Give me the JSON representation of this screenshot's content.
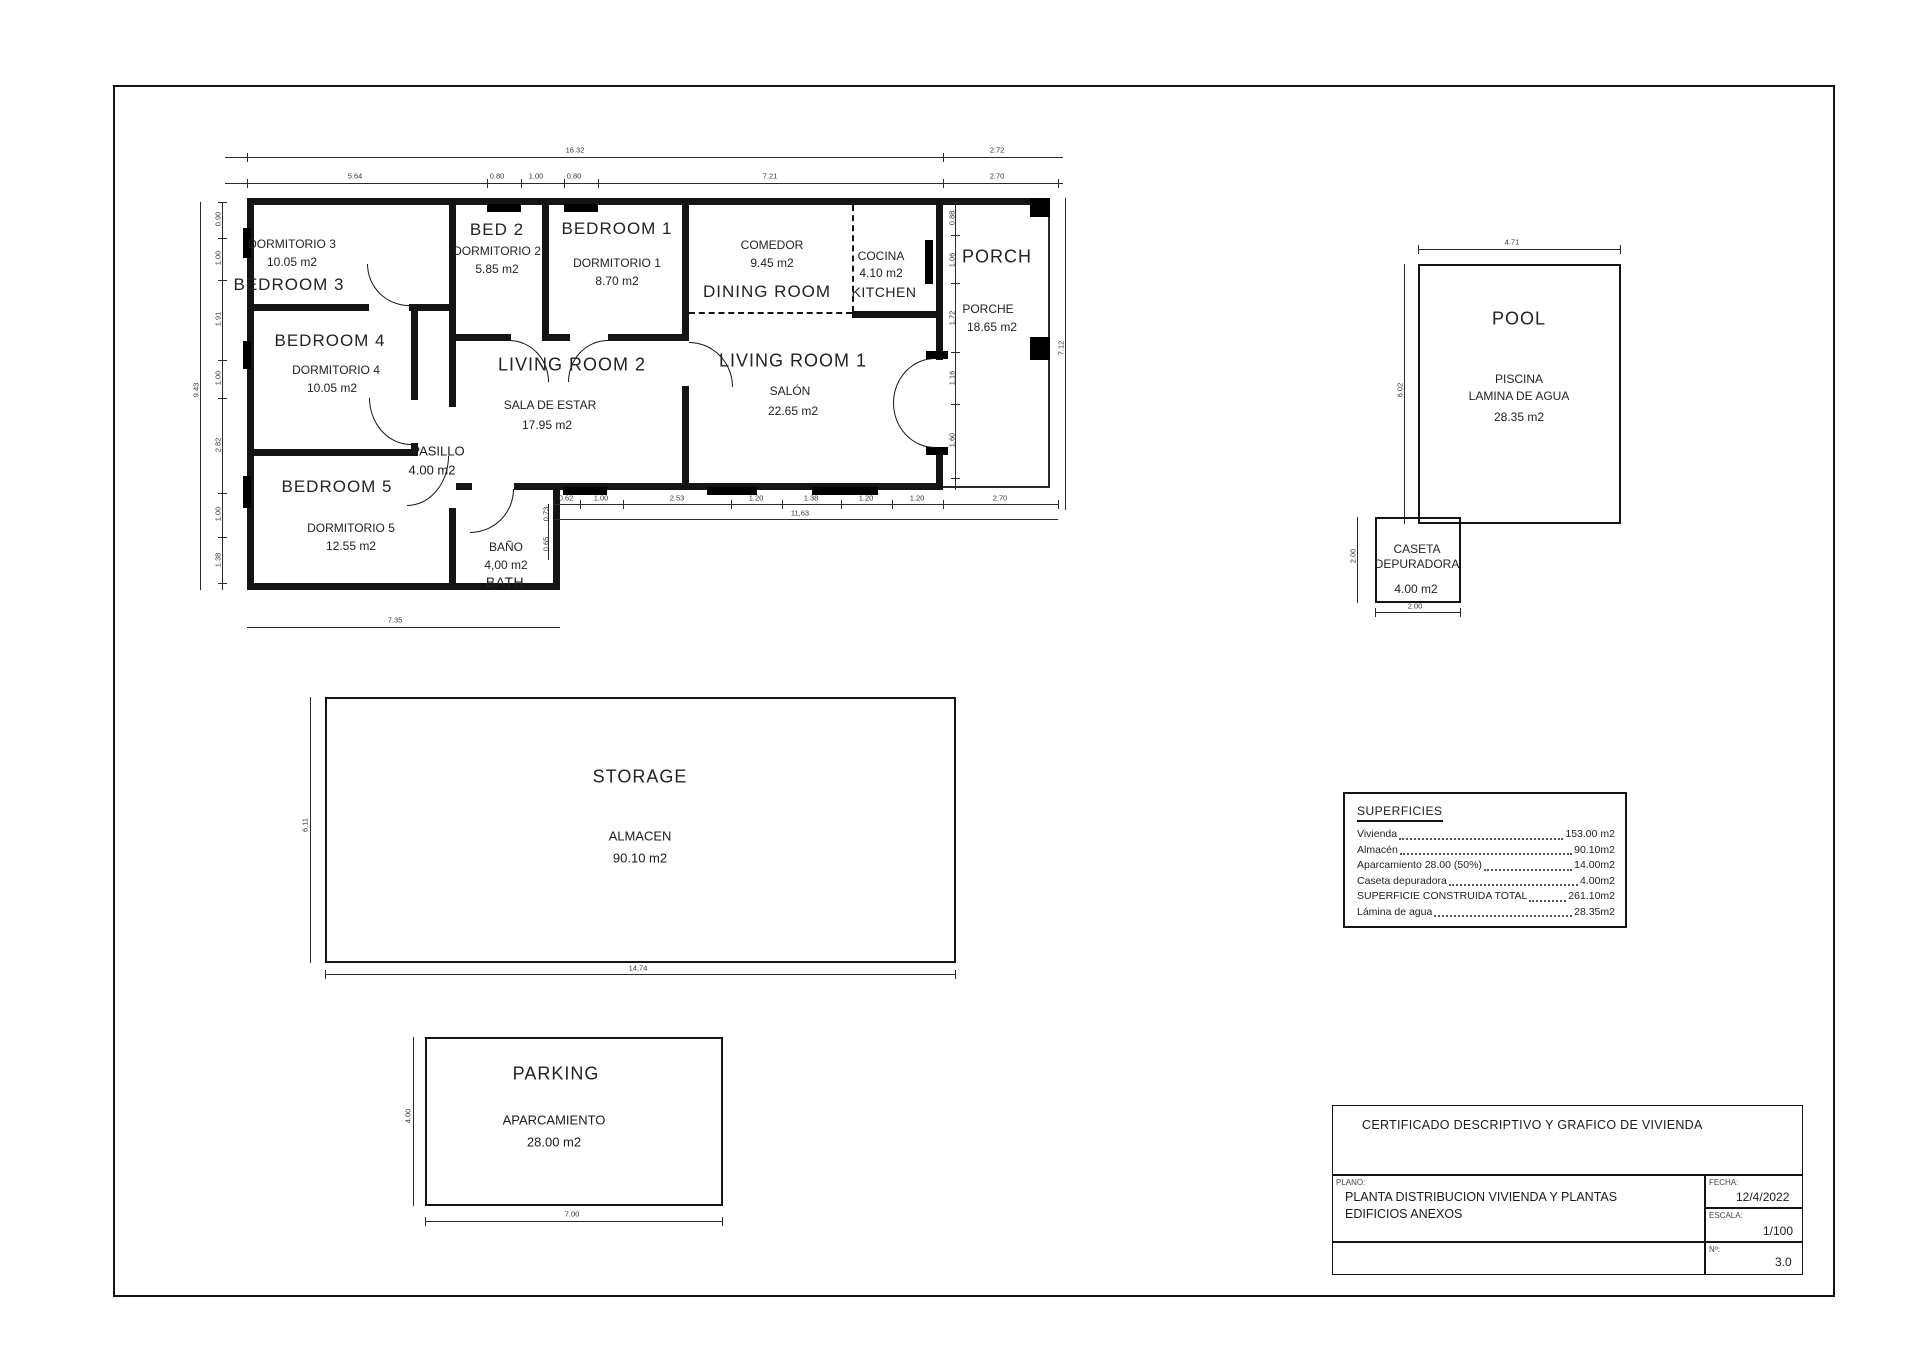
{
  "rooms": {
    "bedroom3": {
      "title": "BEDROOM 3",
      "sub": "DORMITORIO 3",
      "area": "10.05 m2"
    },
    "bedroom4": {
      "title": "BEDROOM 4",
      "sub": "DORMITORIO 4",
      "area": "10.05 m2"
    },
    "bedroom5": {
      "title": "BEDROOM 5",
      "sub": "DORMITORIO 5",
      "area": "12.55 m2"
    },
    "bed2": {
      "title": "BED 2",
      "sub": "DORMITORIO 2",
      "area": "5.85 m2"
    },
    "bedroom1": {
      "title": "BEDROOM 1",
      "sub": "DORMITORIO 1",
      "area": "8.70 m2"
    },
    "living2": {
      "title": "LIVING ROOM 2",
      "sub": "SALA DE ESTAR",
      "area": "17.95 m2"
    },
    "living1": {
      "title": "LIVING ROOM 1",
      "sub": "SALÓN",
      "area": "22.65 m2"
    },
    "dining": {
      "title": "DINING ROOM",
      "sub": "COMEDOR",
      "area": "9.45 m2"
    },
    "kitchen": {
      "title": "KITCHEN",
      "sub": "COCINA",
      "area": "4.10 m2"
    },
    "porch": {
      "title": "PORCH",
      "sub": "PORCHE",
      "area": "18.65 m2"
    },
    "pasillo": {
      "title": "PASILLO",
      "area": "4.00 m2"
    },
    "bath": {
      "title": "BATH",
      "sub": "BAÑO",
      "area": "4,00 m2"
    },
    "pool": {
      "title": "POOL",
      "sub": "PISCINA",
      "sub2": "LAMINA DE AGUA",
      "area": "28.35 m2"
    },
    "caseta": {
      "sub": "CASETA",
      "sub2": "DEPURADORA",
      "area": "4.00 m2"
    },
    "storage": {
      "title": "STORAGE",
      "sub": "ALMACEN",
      "area": "90.10 m2"
    },
    "parking": {
      "title": "PARKING",
      "sub": "APARCAMIENTO",
      "area": "28.00 m2"
    }
  },
  "dims": {
    "top_overall": "16.32",
    "top_porch": "2.72",
    "top_porch2": "2.70",
    "top_segs": [
      "5.64",
      "0.80",
      "1.00",
      "0.80",
      "7.21"
    ],
    "left_overall": "9.43",
    "left_segs": [
      "0.90",
      "1.00",
      "1.91",
      "1.00",
      "2.82",
      "1.00",
      "1.38"
    ],
    "right_segs": [
      "0.88",
      "1.06",
      "1.72",
      "1.16",
      "1.60"
    ],
    "right_overall": "7.12",
    "bottom_segs": [
      "0.62",
      "1.00",
      "2.53",
      "1.20",
      "1.38",
      "1.20",
      "1.20",
      "2.70"
    ],
    "bottom_overall": "11,63",
    "bath_segs": [
      "0.73",
      "0.65"
    ],
    "wing_bottom": "7.35",
    "pool_top": "4.71",
    "pool_left": "6.02",
    "caseta_left": "2.00",
    "caseta_bottom": "2.00",
    "storage_left": "6,11",
    "storage_bottom": "14,74",
    "parking_left": "4.00",
    "parking_bottom": "7.00"
  },
  "superficies": {
    "title": "SUPERFICIES",
    "rows": [
      {
        "label": "Vivienda",
        "value": "153.00 m2"
      },
      {
        "label": "Almacén",
        "value": "90.10m2"
      },
      {
        "label": "Aparcamiento 28.00 (50%)",
        "value": "14.00m2"
      },
      {
        "label": "Caseta depuradora",
        "value": "4.00m2"
      },
      {
        "label": "SUPERFICIE CONSTRUIDA TOTAL",
        "value": "261.10m2"
      },
      {
        "label": "Lámina de agua",
        "value": "28.35m2"
      }
    ]
  },
  "titleblock": {
    "certificate": "CERTIFICADO DESCRIPTIVO Y GRAFICO DE VIVIENDA",
    "plano_label": "PLANO:",
    "plano_line1": "PLANTA DISTRIBUCION VIVIENDA Y PLANTAS",
    "plano_line2": "EDIFICIOS ANEXOS",
    "fecha_label": "FECHA:",
    "fecha": "12/4/2022",
    "escala_label": "ESCALA:",
    "escala": "1/100",
    "num_label": "Nº:",
    "num": "3.0"
  }
}
